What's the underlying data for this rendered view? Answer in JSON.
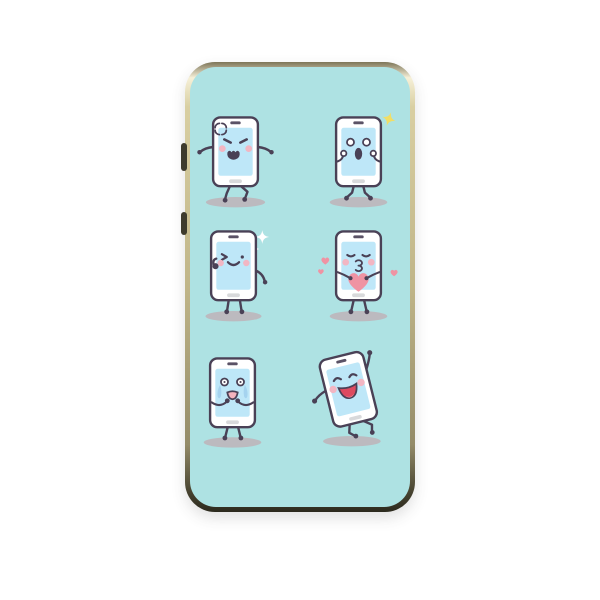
{
  "page": {
    "background_color": "#ffffff",
    "description": "Product photo of a phone case with six cartoon smartphone emoji characters on a mint background"
  },
  "case": {
    "interior_color": "#aee2e3",
    "rim_colors": {
      "highlight": "#f6f0d8",
      "gold": "#c0b588",
      "shadow_edge": "#44402e"
    },
    "side_button_color": "#3e3b2d",
    "side_buttons": [
      {
        "name": "volume-button"
      },
      {
        "name": "power-button"
      }
    ]
  },
  "artwork": {
    "palette": {
      "outline": "#4a4156",
      "phone_body": "#ffffff",
      "screen": "#bee7f8",
      "cheek": "#f2b6c3",
      "shadow": "#bcbabf",
      "speaker": "#5a5266",
      "home_button": "#d8d9db",
      "tears": "#a5d3ef",
      "heart": "#ef93a3",
      "mouth_red": "#dd4a60",
      "tongue": "#f192a2",
      "cry_mouth": "#f4b3bd",
      "sparkle_yellow": "#f1de66",
      "sparkle_white": "#ffffff"
    },
    "characters": [
      {
        "emotion": "angry",
        "label": "Angry phone with anger mark, arms spread, stomping"
      },
      {
        "emotion": "surprised",
        "label": "Surprised phone with round eyes, hands to face, yellow flash sparkle"
      },
      {
        "emotion": "winking",
        "label": "Winking phone giving a thumbs up with white sparkles"
      },
      {
        "emotion": "kissing",
        "label": "Kissing phone holding a big pink heart with small hearts floating"
      },
      {
        "emotion": "crying",
        "label": "Crying phone with streaming tears and fists at its mouth"
      },
      {
        "emotion": "dancing",
        "label": "Laughing phone dancing with one arm raised"
      }
    ]
  }
}
